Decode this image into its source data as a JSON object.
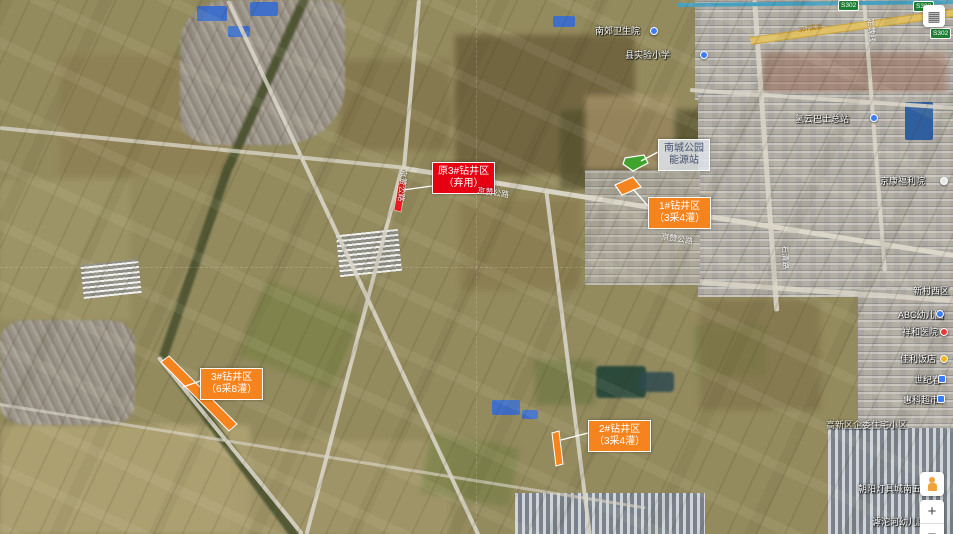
{
  "annotations": {
    "abandoned": {
      "line1": "原3#钻井区",
      "line2": "（弃用）"
    },
    "energy_station": {
      "line1": "南城公园",
      "line2": "能源站"
    },
    "zone1": {
      "line1": "1#钻井区",
      "line2": "（3采4灌）"
    },
    "zone2": {
      "line1": "2#钻井区",
      "line2": "（3采4灌）"
    },
    "zone3": {
      "line1": "3#钻井区",
      "line2": "（6采8灌）"
    }
  },
  "colors": {
    "zone_orange": "#f5841e",
    "abandoned_red": "#e60012",
    "station_green": "#3fa32e",
    "station_label_bg": "#e0e4ec",
    "station_label_text": "#44536e"
  },
  "pois": [
    {
      "text": "南郊卫生院"
    },
    {
      "text": "县实验小学"
    },
    {
      "text": "氢云巴士总站"
    },
    {
      "text": "京康福利院"
    },
    {
      "text": "新村西区"
    },
    {
      "text": "ABC幼儿园"
    },
    {
      "text": "祥和医院"
    },
    {
      "text": "佳利饭店"
    },
    {
      "text": "世纪春"
    },
    {
      "text": "惠科超市"
    },
    {
      "text": "高新区企委住宅小区"
    },
    {
      "text": "朝阳灯具城南五金城"
    },
    {
      "text": "滹沱河幼儿园"
    }
  ],
  "road_labels": [
    {
      "text": "京赞公路"
    },
    {
      "text": "京赞公路"
    },
    {
      "text": "京赞公路"
    },
    {
      "text": "石清路"
    },
    {
      "text": "定魏线"
    },
    {
      "text": "307国道"
    }
  ],
  "shields": [
    {
      "text": "S302"
    },
    {
      "text": "S302"
    },
    {
      "text": "S302"
    }
  ],
  "controls": {
    "layers_glyph": "▦",
    "zoom_in": "+",
    "zoom_out": "−"
  }
}
